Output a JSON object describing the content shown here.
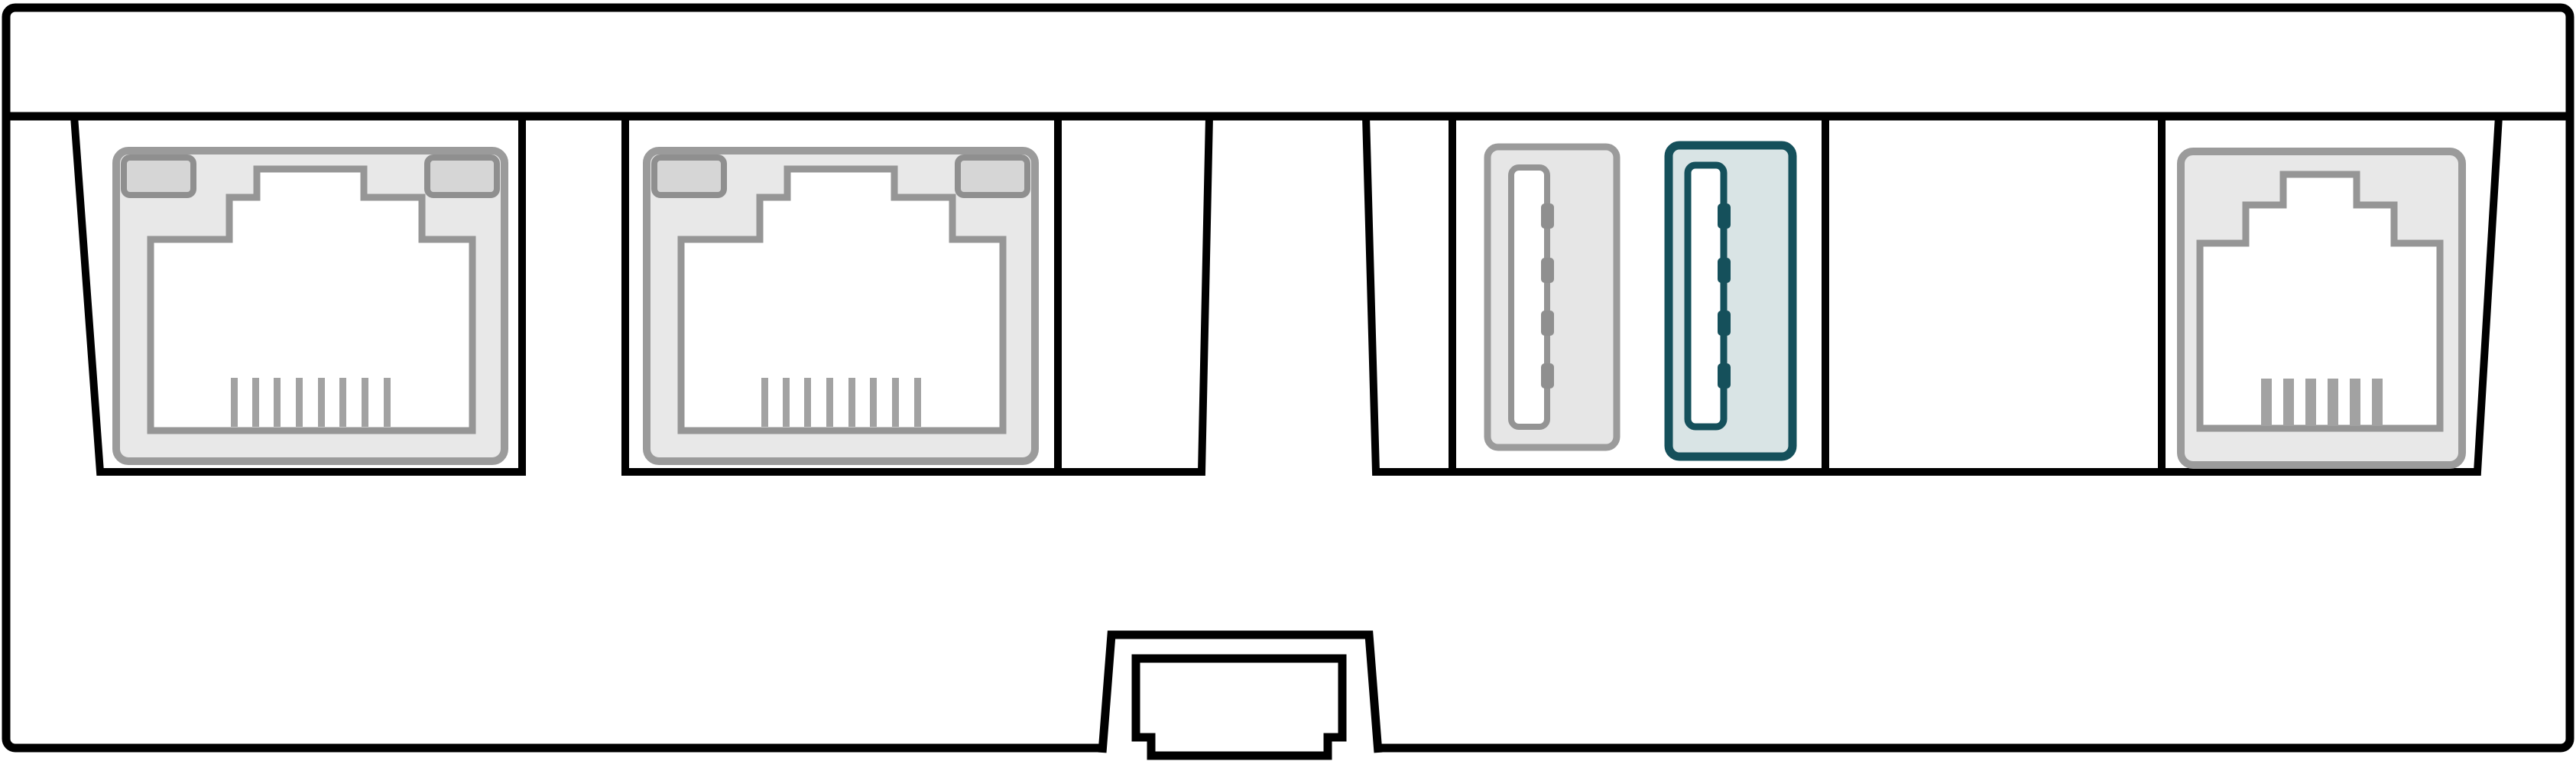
{
  "diagram": {
    "kind": "hardware-rear-panel-line-drawing",
    "sections": {
      "ethernet_bay_1": {
        "name": "ethernet-bay-1",
        "contains": "ethernet-port-1"
      },
      "ethernet_bay_2": {
        "name": "ethernet-bay-2",
        "contains": "ethernet-port-2-and-empty-slot"
      },
      "vent_tab": {
        "name": "raised-trapezoid-tab"
      },
      "io_bay": {
        "name": "usb-and-console-bay",
        "contains": "usb-ports-empty-slot-console-port"
      }
    },
    "ports": {
      "ethernet_ports": [
        {
          "name": "ethernet-port-1",
          "pins": 8,
          "led_windows": 2
        },
        {
          "name": "ethernet-port-2",
          "pins": 8,
          "led_windows": 2
        }
      ],
      "usb_ports": [
        {
          "name": "usb-port-standard",
          "contacts": 4,
          "style": "gray"
        },
        {
          "name": "usb-port-highlighted",
          "contacts": 4,
          "style": "teal"
        }
      ],
      "console_port": {
        "name": "console-port",
        "pins": 6,
        "led_windows": 0
      },
      "bottom_connector": {
        "name": "bottom-expansion-connector"
      }
    },
    "counts": {
      "ethernet_ports": 2,
      "usb_ports": 2,
      "console_ports": 1,
      "bottom_connectors": 1,
      "recessed_bays": 3,
      "bay_dividers": 4
    }
  },
  "colors": {
    "outline": "#000000",
    "panel_fill": "#ffffff",
    "white": "#ffffff",
    "none": "none",
    "bezel_fill": "#e8e8e8",
    "bezel_stroke": "#9b9b9b",
    "led_fill": "#d6d6d6",
    "led_stroke": "#8f8f8f",
    "socket_stroke": "#969696",
    "pin_gray": "#a2a2a2",
    "usb_body_fill": "#e6e6e6",
    "usb_body_stroke": "#9b9b9b",
    "usb_slot_stroke": "#949494",
    "usb_pin": "#8f8f8f",
    "usb3_fill": "#d9e4e5",
    "usb3_stroke": "#15505b"
  }
}
